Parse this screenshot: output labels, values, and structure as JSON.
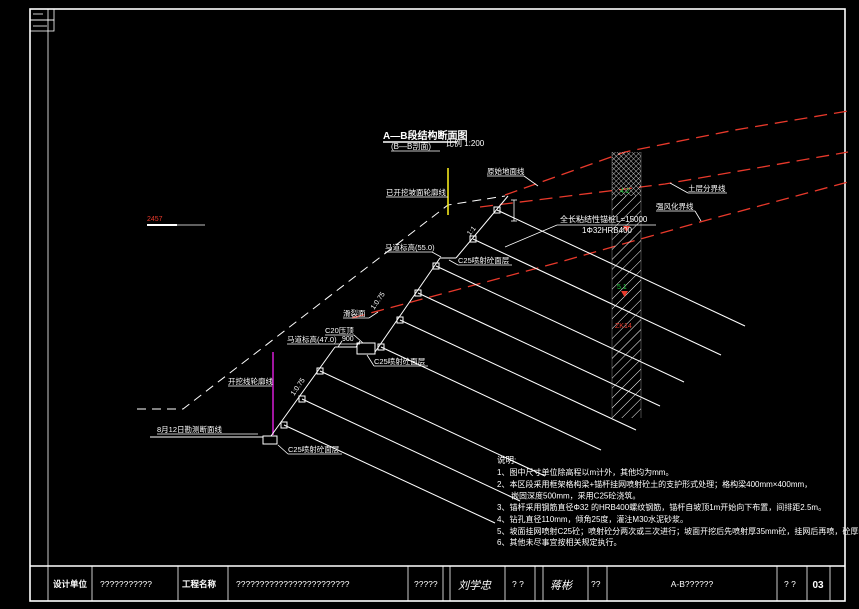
{
  "colors": {
    "background": "#000000",
    "line": "#ffffff",
    "red": "#e8392b",
    "yellow": "#f2e71c",
    "magenta": "#e520e5",
    "green": "#18c835"
  },
  "title": {
    "main": "A—B段结构断面图",
    "sub": "(B—B剖面)",
    "scale": "比例 1:200"
  },
  "labels": {
    "original_ground": "原始地面线",
    "excavated_outline": "已开挖坡面轮廓线",
    "soil_boundary": "土层分界线",
    "weathered_boundary": "强风化界线",
    "anchor_spec_1": "全长粘结性锚桩L=15000",
    "anchor_spec_2": "1Φ32HRB400",
    "berm_55": "马道标高(55.0)",
    "shotcrete": "C25喷射砼面层",
    "slip_surface": "滑裂面",
    "cap": "C20压顶",
    "berm_47": "马道标高(47.0)",
    "dim_900": "900",
    "excavation_line": "开挖线轮廓线",
    "survey_line": "8月12日勘测断面线",
    "grade_1_1": "1:1",
    "grade_1_075": "1:0.75",
    "elevation_mark": "2457"
  },
  "borehole": {
    "layer_top": "4.2",
    "layer_mid": "5.1",
    "id": "ZK14"
  },
  "notes": {
    "heading": "说明:",
    "items": [
      "1、图中尺寸单位除高程以m计外，其他均为mm。",
      "2、本区段采用框架格构梁+锚杆挂网喷射砼土的支护形式处理；格构梁400mm×400mm，",
      "嵌固深度500mm，采用C25砼浇筑。",
      "3、锚杆采用钢筋直径Φ32 的HRB400螺纹钢筋，锚杆自坡顶1m开始向下布置，间排距2.5m。",
      "4、钻孔直径110mm，倾角25度，灌注M30水泥砂浆。",
      "5、坡面挂网喷射C25砼；喷射砼分两次或三次进行；坡面开挖后先喷射厚35mm砼，挂网后再喷，砼厚55mm。",
      "6、其他未尽事宜按相关规定执行。"
    ]
  },
  "title_block": {
    "design_unit_label": "设计单位",
    "design_unit_value": "???????????",
    "project_label": "工程名称",
    "project_value": "????????????????????????",
    "cell_5": "?????",
    "signature_1": "刘学忠",
    "cell_7": "?  ?",
    "signature_2": "蒋彬",
    "cell_9": "??",
    "drawing_title": "A-B??????",
    "cell_11": "?  ?",
    "sheet_no": "03"
  }
}
